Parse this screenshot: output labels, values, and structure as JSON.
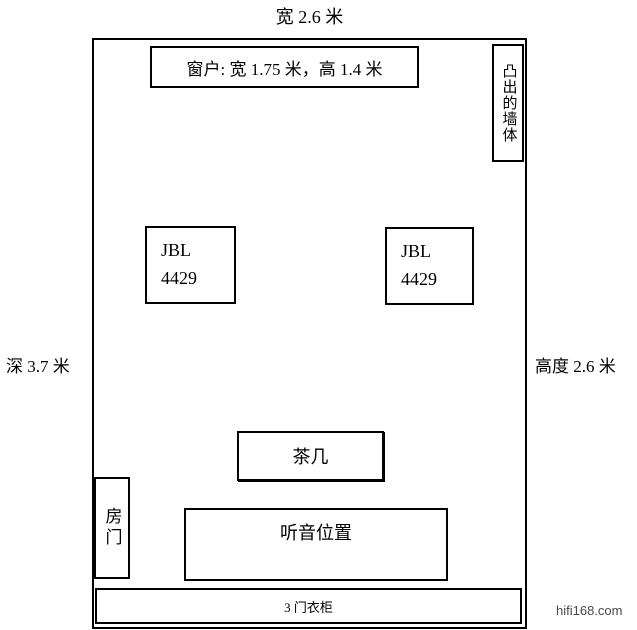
{
  "diagram": {
    "dimensions": {
      "width_label": "宽 2.6 米",
      "depth_label": "深 3.7 米",
      "height_label": "高度 2.6 米"
    },
    "window": {
      "label": "窗户: 宽 1.75 米，高 1.4 米"
    },
    "protruding_wall": {
      "label": "凸出的墙体"
    },
    "speakers": {
      "left": {
        "line1": "JBL",
        "line2": "4429"
      },
      "right": {
        "line1": "JBL",
        "line2": "4429"
      }
    },
    "tea_table": {
      "label": "茶几"
    },
    "door": {
      "label": "房门"
    },
    "listening_position": {
      "label": "听音位置"
    },
    "wardrobe": {
      "label": "3 门衣柜"
    },
    "watermark": "hifi168.com",
    "colors": {
      "line": "#000000",
      "background": "#ffffff",
      "watermark_text": "#4a4a4a"
    }
  }
}
